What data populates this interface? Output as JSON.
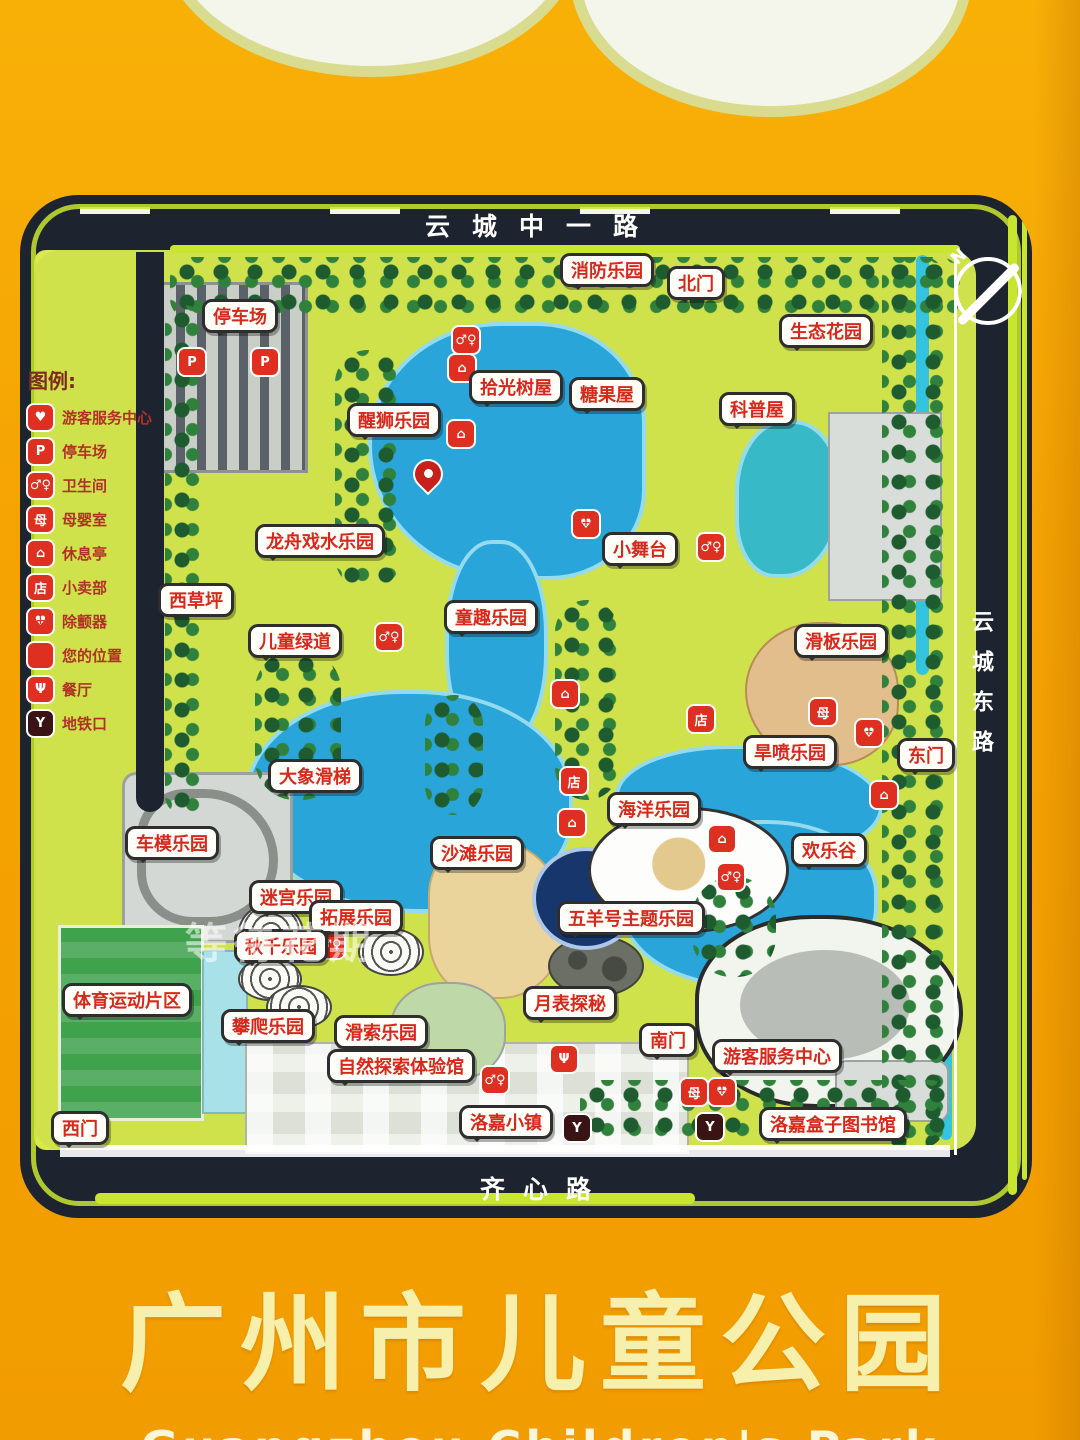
{
  "sign": {
    "title": "广州市儿童公园",
    "subtitle_partial": "Guangzhou Children's Park"
  },
  "roads": {
    "top": "云城中一路",
    "right": "云城东路",
    "bottom": "齐心路"
  },
  "compass": {
    "label": "N"
  },
  "watermark": "等待花期",
  "legend": {
    "title": "图例:",
    "items": [
      {
        "icon": "visitor-center",
        "label": "游客服务中心"
      },
      {
        "icon": "parking",
        "label": "停车场"
      },
      {
        "icon": "toilet",
        "label": "卫生间"
      },
      {
        "icon": "baby",
        "label": "母婴室"
      },
      {
        "icon": "pavilion",
        "label": "休息亭"
      },
      {
        "icon": "kiosk",
        "label": "小卖部"
      },
      {
        "icon": "aed",
        "label": "除颤器"
      },
      {
        "icon": "pin",
        "label": "您的位置"
      },
      {
        "icon": "restaurant",
        "label": "餐厅"
      },
      {
        "icon": "metro",
        "label": "地铁口"
      }
    ]
  },
  "icon_glyphs": {
    "visitor-center": "♥",
    "parking": "P",
    "toilet": "♂♀",
    "baby": "母",
    "pavilion": "⌂",
    "kiosk": "店",
    "aed": "♥",
    "pin": "",
    "restaurant": "Ψ",
    "metro": "Y"
  },
  "map": {
    "labels": [
      {
        "text": "消防乐园",
        "x": 607,
        "y": 270
      },
      {
        "text": "北门",
        "x": 696,
        "y": 283
      },
      {
        "text": "生态花园",
        "x": 826,
        "y": 331
      },
      {
        "text": "停车场",
        "x": 240,
        "y": 316
      },
      {
        "text": "拾光树屋",
        "x": 516,
        "y": 387
      },
      {
        "text": "糖果屋",
        "x": 607,
        "y": 394
      },
      {
        "text": "科普屋",
        "x": 757,
        "y": 409
      },
      {
        "text": "醒狮乐园",
        "x": 394,
        "y": 420
      },
      {
        "text": "龙舟戏水乐园",
        "x": 320,
        "y": 541
      },
      {
        "text": "小舞台",
        "x": 640,
        "y": 549
      },
      {
        "text": "西草坪",
        "x": 196,
        "y": 600
      },
      {
        "text": "童趣乐园",
        "x": 491,
        "y": 617
      },
      {
        "text": "儿童绿道",
        "x": 295,
        "y": 641
      },
      {
        "text": "滑板乐园",
        "x": 841,
        "y": 641
      },
      {
        "text": "旱喷乐园",
        "x": 790,
        "y": 752
      },
      {
        "text": "东门",
        "x": 926,
        "y": 755
      },
      {
        "text": "大象滑梯",
        "x": 315,
        "y": 776
      },
      {
        "text": "海洋乐园",
        "x": 654,
        "y": 809
      },
      {
        "text": "车模乐园",
        "x": 172,
        "y": 843
      },
      {
        "text": "沙滩乐园",
        "x": 477,
        "y": 853
      },
      {
        "text": "欢乐谷",
        "x": 829,
        "y": 850
      },
      {
        "text": "迷宫乐园",
        "x": 296,
        "y": 897
      },
      {
        "text": "拓展乐园",
        "x": 356,
        "y": 917
      },
      {
        "text": "五羊号主题乐园",
        "x": 631,
        "y": 918
      },
      {
        "text": "秋千乐园",
        "x": 281,
        "y": 946
      },
      {
        "text": "体育运动片区",
        "x": 127,
        "y": 1000
      },
      {
        "text": "攀爬乐园",
        "x": 268,
        "y": 1026
      },
      {
        "text": "滑索乐园",
        "x": 381,
        "y": 1032
      },
      {
        "text": "月表探秘",
        "x": 570,
        "y": 1003
      },
      {
        "text": "南门",
        "x": 668,
        "y": 1040
      },
      {
        "text": "游客服务中心",
        "x": 777,
        "y": 1056
      },
      {
        "text": "自然探索体验馆",
        "x": 401,
        "y": 1066
      },
      {
        "text": "洛嘉小镇",
        "x": 506,
        "y": 1122
      },
      {
        "text": "洛嘉盒子图书馆",
        "x": 833,
        "y": 1124
      },
      {
        "text": "西门",
        "x": 80,
        "y": 1128
      }
    ],
    "icons": [
      {
        "type": "parking",
        "x": 192,
        "y": 362
      },
      {
        "type": "parking",
        "x": 265,
        "y": 362
      },
      {
        "type": "toilet",
        "x": 466,
        "y": 340
      },
      {
        "type": "pavilion",
        "x": 462,
        "y": 368
      },
      {
        "type": "pavilion",
        "x": 461,
        "y": 434
      },
      {
        "type": "pin",
        "x": 429,
        "y": 477
      },
      {
        "type": "aed",
        "x": 586,
        "y": 524
      },
      {
        "type": "toilet",
        "x": 711,
        "y": 547
      },
      {
        "type": "toilet",
        "x": 389,
        "y": 637
      },
      {
        "type": "pavilion",
        "x": 565,
        "y": 694
      },
      {
        "type": "kiosk",
        "x": 701,
        "y": 719
      },
      {
        "type": "baby",
        "x": 823,
        "y": 712
      },
      {
        "type": "aed",
        "x": 869,
        "y": 733
      },
      {
        "type": "kiosk",
        "x": 574,
        "y": 781
      },
      {
        "type": "pavilion",
        "x": 572,
        "y": 823
      },
      {
        "type": "pavilion",
        "x": 722,
        "y": 839
      },
      {
        "type": "pavilion",
        "x": 884,
        "y": 795
      },
      {
        "type": "toilet",
        "x": 731,
        "y": 877
      },
      {
        "type": "toilet",
        "x": 331,
        "y": 945
      },
      {
        "type": "restaurant",
        "x": 564,
        "y": 1059
      },
      {
        "type": "toilet",
        "x": 495,
        "y": 1080
      },
      {
        "type": "baby",
        "x": 694,
        "y": 1092
      },
      {
        "type": "aed",
        "x": 722,
        "y": 1092
      },
      {
        "type": "metro",
        "x": 577,
        "y": 1128
      },
      {
        "type": "metro",
        "x": 710,
        "y": 1127
      }
    ]
  }
}
